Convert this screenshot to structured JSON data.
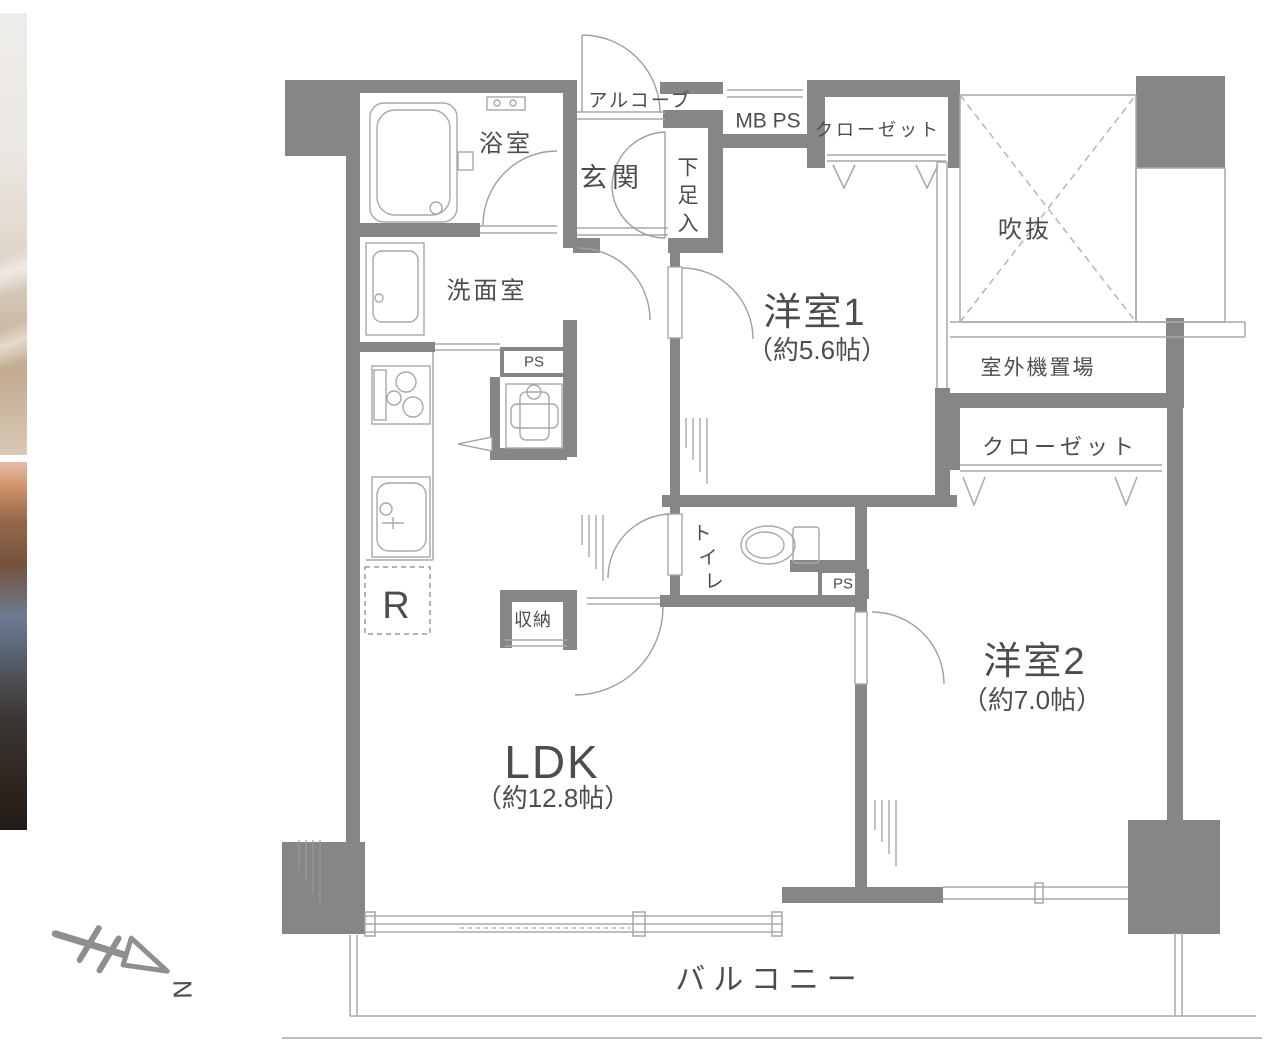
{
  "floor_plan": {
    "colors": {
      "wall": "#868686",
      "thin_line": "#a8a8a8",
      "dash_line": "#b5b5b5",
      "text": "#4d4d4d",
      "compass": "#8f8f8f"
    },
    "rooms": {
      "alcove": {
        "label": "アルコーブ"
      },
      "mb_ps": {
        "label": "MB PS"
      },
      "closet1": {
        "label": "クローゼット"
      },
      "closet2": {
        "label": "クローゼット"
      },
      "void": {
        "label": "吹抜"
      },
      "outdoor_unit": {
        "label": "室外機置場"
      },
      "bathroom": {
        "label": "浴室"
      },
      "entrance": {
        "label": "玄関"
      },
      "shoe_closet": {
        "label": "下足入",
        "chars": [
          "下",
          "足",
          "入"
        ]
      },
      "washroom": {
        "label": "洗面室"
      },
      "ps_upper": {
        "label": "PS"
      },
      "storage": {
        "label": "収納"
      },
      "refrigerator": {
        "label": "R"
      },
      "toilet": {
        "label": "トイレ",
        "chars": [
          "ト",
          "イ",
          "レ"
        ]
      },
      "ps_toilet": {
        "label": "PS"
      },
      "western1": {
        "label": "洋室1",
        "size": "（約5.6帖）"
      },
      "western2": {
        "label": "洋室2",
        "size": "（約7.0帖）"
      },
      "ldk": {
        "label": "LDK",
        "size": "（約12.8帖）"
      },
      "balcony": {
        "label": "バルコニー"
      }
    },
    "compass": {
      "label": "N"
    }
  }
}
